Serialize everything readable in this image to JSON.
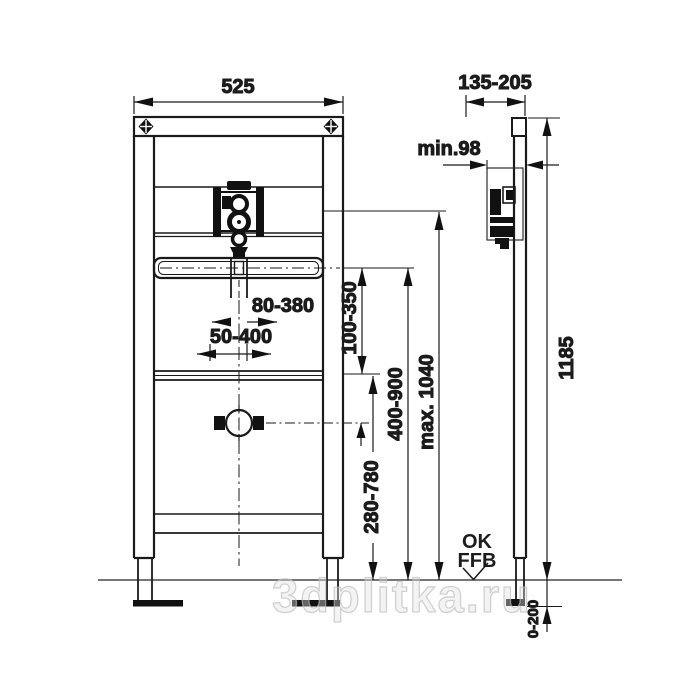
{
  "drawing": {
    "front_view": {
      "width": "525",
      "flush_pipe_offset": "80-380",
      "fixture_width": "50-400",
      "dim_100_350": "100-350",
      "dim_400_900": "400-900",
      "dim_max_1040": "max. 1040",
      "dim_280_780": "280-780"
    },
    "side_view": {
      "depth": "135-205",
      "min_clearance": "min.98",
      "height": "1185",
      "floor_line1": "OK",
      "floor_line2": "FFB",
      "foot_adjust": "0-200"
    },
    "watermark": "3dplitka.ru"
  }
}
